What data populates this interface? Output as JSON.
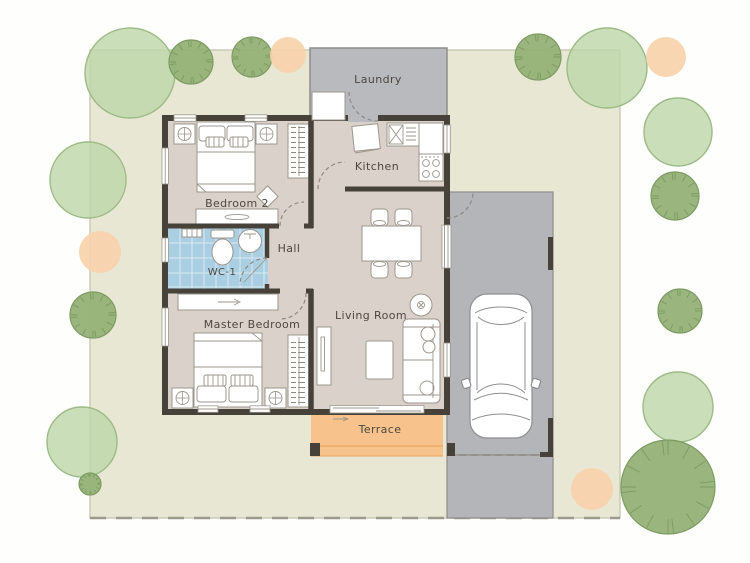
{
  "plan": {
    "labels": {
      "laundry": "Laundry",
      "kitchen": "Kitchen",
      "bedroom2": "Bedroom 2",
      "wc": "WC-1",
      "hall": "Hall",
      "master": "Master Bedroom",
      "living": "Living Room",
      "terrace": "Terrace"
    }
  },
  "colors": {
    "lot": "#e8e7d3",
    "lotEdge": "#cccbb6",
    "lotDash": "#9a998c",
    "houseFloor": "#dad2ca",
    "laundry": "#b9babe",
    "garage": "#b3b5b9",
    "garageEdge": "#8f8d89",
    "wc": "#abcfe2",
    "terrace": "#f8c28c",
    "terraceEdge": "#eaa660",
    "wall": "#46423a",
    "furnStroke": "#9c968c",
    "furnFill": "#ffffff",
    "door": "#8d8880",
    "treeLight": "#bed7ab",
    "treeLightEdge": "#9dbb86",
    "treeDark": "#95b277",
    "treeDarkEdge": "#7c9b61",
    "shrub": "#f7d2ab",
    "label": "#4d483f",
    "carStroke": "#8f8f8f"
  },
  "site": {
    "trees": [
      {
        "kind": "light",
        "cx": 130,
        "cy": 73,
        "r": 45
      },
      {
        "kind": "dark",
        "cx": 191,
        "cy": 62,
        "r": 22
      },
      {
        "kind": "dark",
        "cx": 252,
        "cy": 57,
        "r": 20
      },
      {
        "kind": "shrub",
        "cx": 288,
        "cy": 55,
        "r": 18
      },
      {
        "kind": "dark",
        "cx": 538,
        "cy": 57,
        "r": 23
      },
      {
        "kind": "light",
        "cx": 607,
        "cy": 68,
        "r": 40
      },
      {
        "kind": "shrub",
        "cx": 666,
        "cy": 57,
        "r": 20
      },
      {
        "kind": "light",
        "cx": 678,
        "cy": 132,
        "r": 34
      },
      {
        "kind": "dark",
        "cx": 675,
        "cy": 196,
        "r": 24
      },
      {
        "kind": "dark",
        "cx": 680,
        "cy": 311,
        "r": 22
      },
      {
        "kind": "light",
        "cx": 678,
        "cy": 407,
        "r": 35
      },
      {
        "kind": "dark",
        "cx": 668,
        "cy": 487,
        "r": 47
      },
      {
        "kind": "shrub",
        "cx": 592,
        "cy": 489,
        "r": 21
      },
      {
        "kind": "light",
        "cx": 88,
        "cy": 180,
        "r": 38
      },
      {
        "kind": "shrub",
        "cx": 100,
        "cy": 252,
        "r": 21
      },
      {
        "kind": "dark",
        "cx": 93,
        "cy": 315,
        "r": 23
      },
      {
        "kind": "light",
        "cx": 82,
        "cy": 442,
        "r": 35
      },
      {
        "kind": "dark",
        "cx": 90,
        "cy": 484,
        "r": 11
      }
    ]
  }
}
